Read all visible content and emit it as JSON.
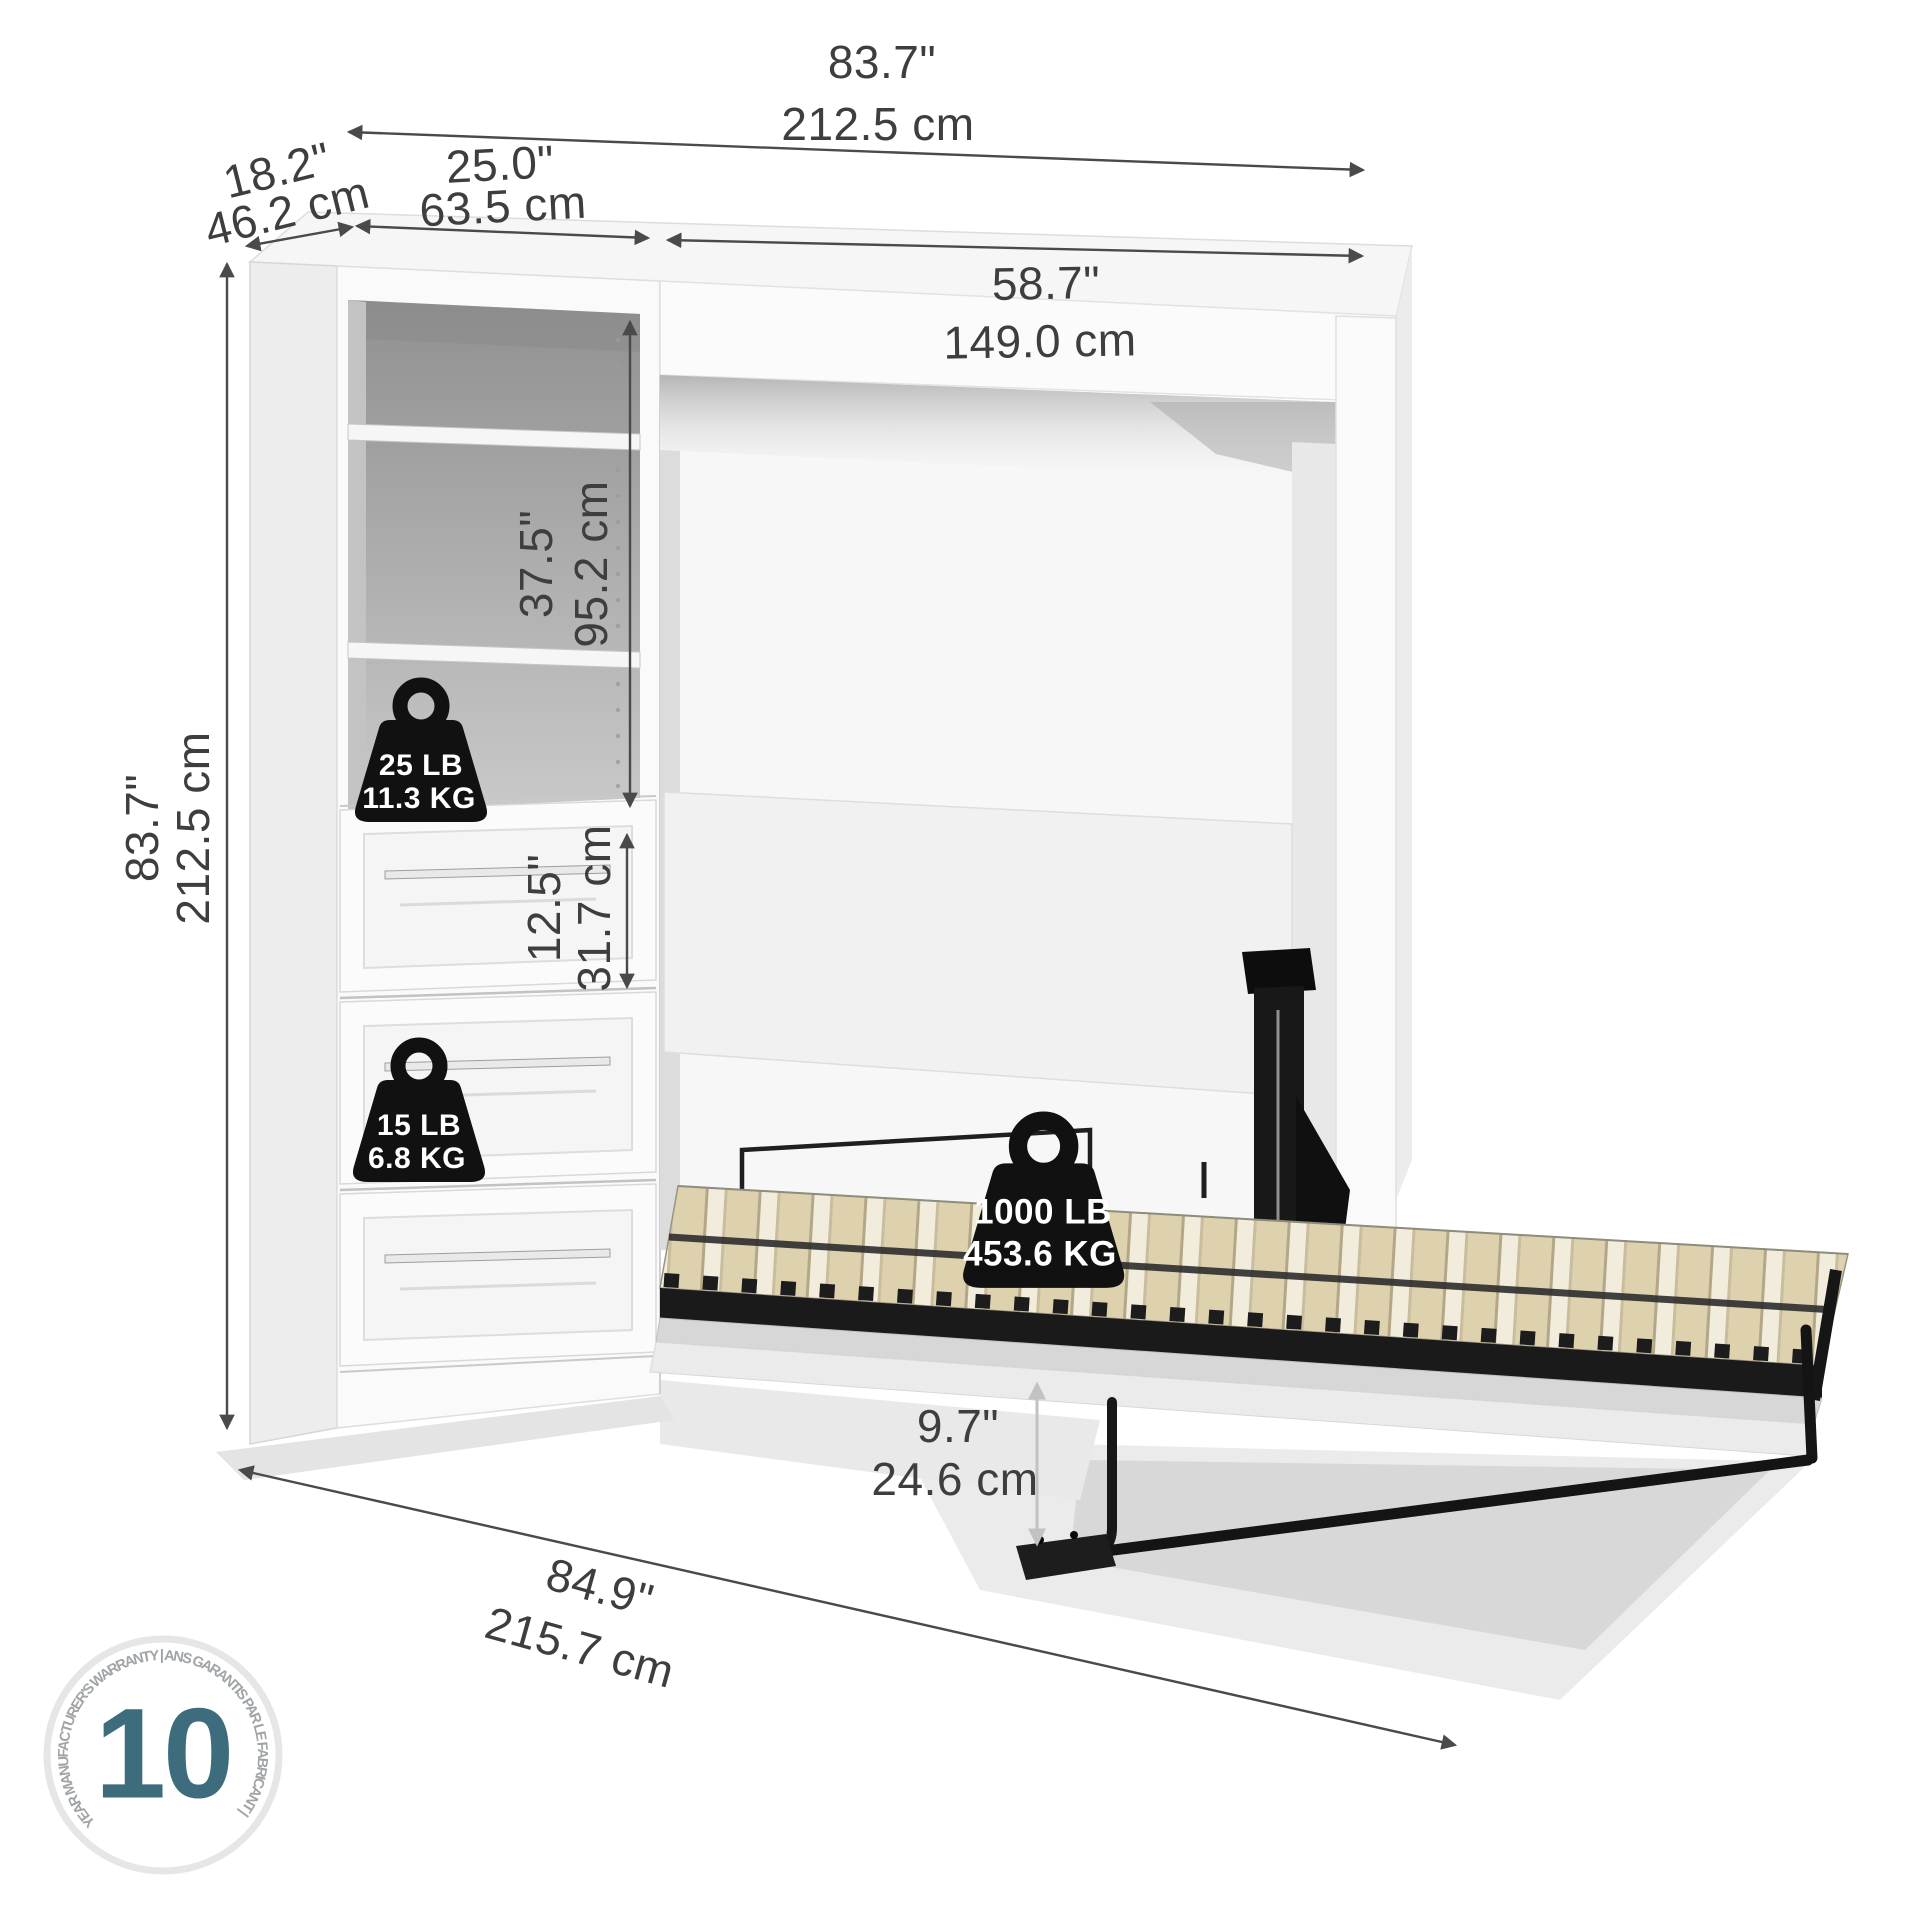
{
  "dimensions": {
    "total_width": {
      "inches": "83.7\"",
      "cm": "212.5 cm"
    },
    "side_depth": {
      "inches": "18.2\"",
      "cm": "46.2 cm"
    },
    "shelving_width": {
      "inches": "25.0\"",
      "cm": "63.5 cm"
    },
    "bed_section_width": {
      "inches": "58.7\"",
      "cm": "149.0 cm"
    },
    "total_height": {
      "inches": "83.7\"",
      "cm": "212.5 cm"
    },
    "shelf_opening_height": {
      "inches": "37.5\"",
      "cm": "95.2 cm"
    },
    "drawer_height": {
      "inches": "12.5\"",
      "cm": "31.7 cm"
    },
    "bed_floor_clearance": {
      "inches": "9.7\"",
      "cm": "24.6 cm"
    },
    "open_depth": {
      "inches": "84.9\"",
      "cm": "215.7 cm"
    }
  },
  "weight_capacities": {
    "shelf": {
      "pounds": "25 LB",
      "kilograms": "11.3 KG"
    },
    "drawer": {
      "pounds": "15 LB",
      "kilograms": "6.8 KG"
    },
    "bed": {
      "pounds": "1000 LB",
      "kilograms": "453.6 KG"
    }
  },
  "warranty": {
    "years": "10",
    "ring_text": "YEAR MANUFACTURER'S WARRANTY   |   ANS GARANTIS PAR LE FABRICANT   |"
  },
  "colors": {
    "dimension_text": "#3d3e40",
    "arrow": "#4a4a4a",
    "light_arrow": "#c2c2c2",
    "warranty_accent": "#3d6d7d",
    "metal_black": "#161616",
    "slat_wood": "#ddd1ae"
  }
}
